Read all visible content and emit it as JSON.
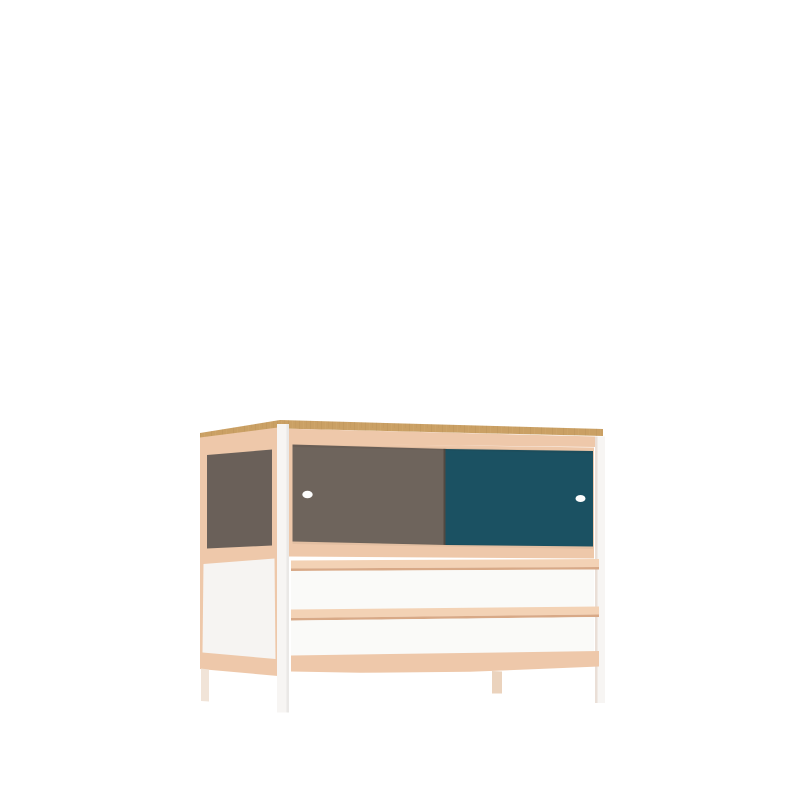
{
  "scene": {
    "description": "Product render of a sideboard: oak top edge, beech wood rails, grey and petrol-blue sliding doors with round finger holes, two white drawers with beech lip handles, white steel legs, plain white background",
    "background": "#ffffff"
  },
  "colors": {
    "background": "#ffffff",
    "oak": "#caa064",
    "beech": "#eec8aa",
    "beech_bright": "#f3d2b5",
    "beech_shadow": "#d8a987",
    "door_gray": "#6e645c",
    "side_gray": "#6a6059",
    "door_teal": "#1b5162",
    "panel_white": "#f6f4f2",
    "drawer_white": "#fafaf8",
    "leg_white": "#f7f5f3",
    "leg_back_left": "#f1e4d8",
    "leg_back_right": "#ebd3bd",
    "handle_white": "#fdfdfd"
  }
}
